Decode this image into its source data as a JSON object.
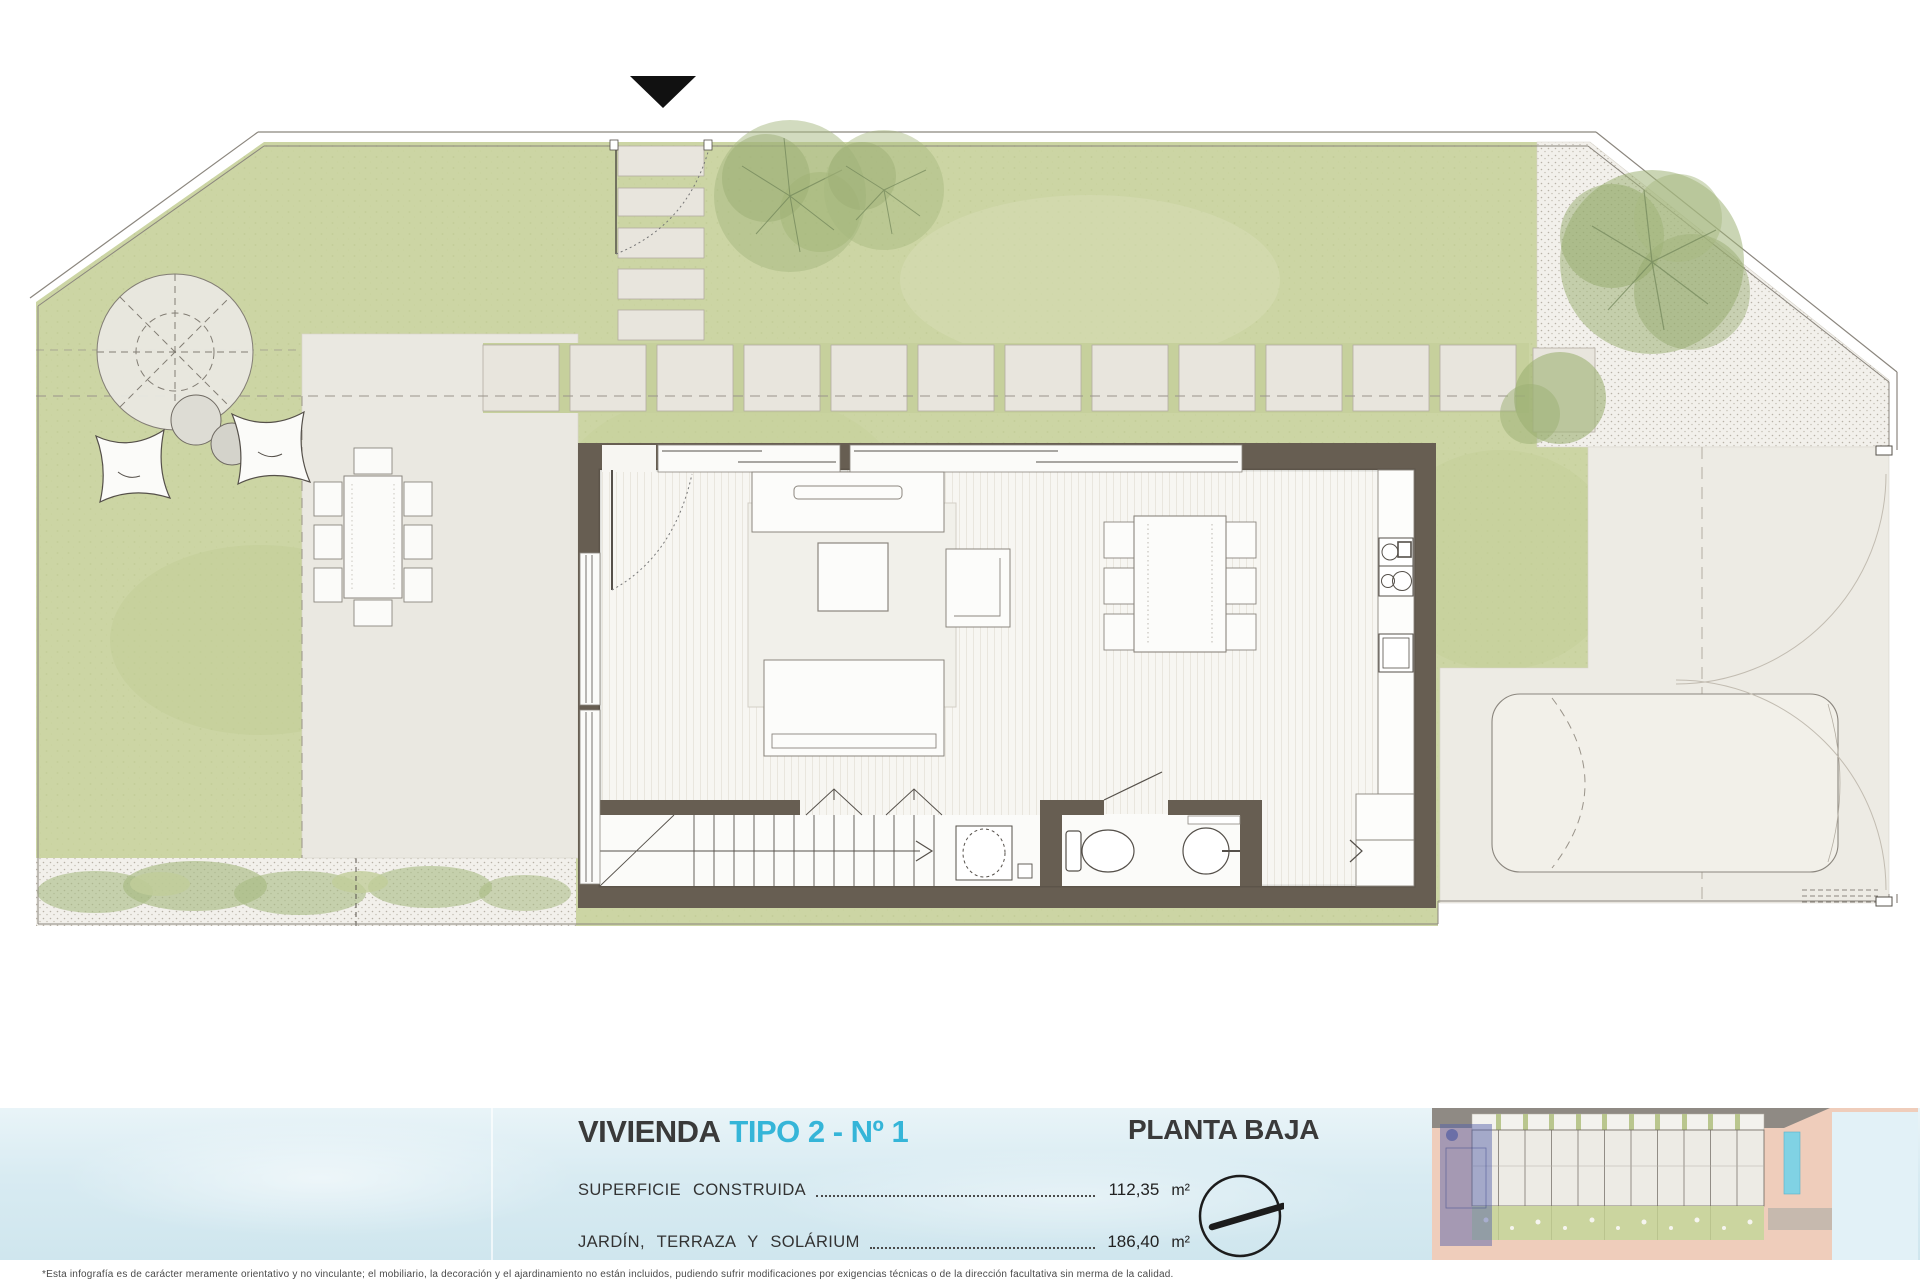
{
  "legend": {
    "title_main": "VIVIENDA",
    "title_accent": "TIPO 2 - Nº 1",
    "floor_label": "PLANTA BAJA",
    "rows": [
      {
        "label": "SUPERFICIE   CONSTRUIDA",
        "value": "112,35",
        "unit": "m²"
      },
      {
        "label": "JARDÍN,  TERRAZA  Y  SOLÁRIUM",
        "value": "186,40",
        "unit": "m²"
      }
    ]
  },
  "disclaimer": "*Esta infografía es de carácter meramente orientativo y no vinculante; el mobiliario, la decoración y el ajardinamiento no están incluidos, pudiendo sufrir modificaciones por exigencias técnicas o de la dirección facultativa sin merma de la calidad.",
  "icons": {
    "north_arrow": "north-arrow-icon",
    "compass": "north-compass-icon"
  },
  "colors": {
    "accent_cyan": "#35b5d8",
    "wall": "#675e52",
    "grass": "#ccd5a4",
    "paving": "#e8e5dd",
    "gravel": "#f2f0eb",
    "water_strip": "#d8ebf2",
    "highlighted_unit": "#5460ac",
    "text_dark": "#3a3a3a"
  }
}
